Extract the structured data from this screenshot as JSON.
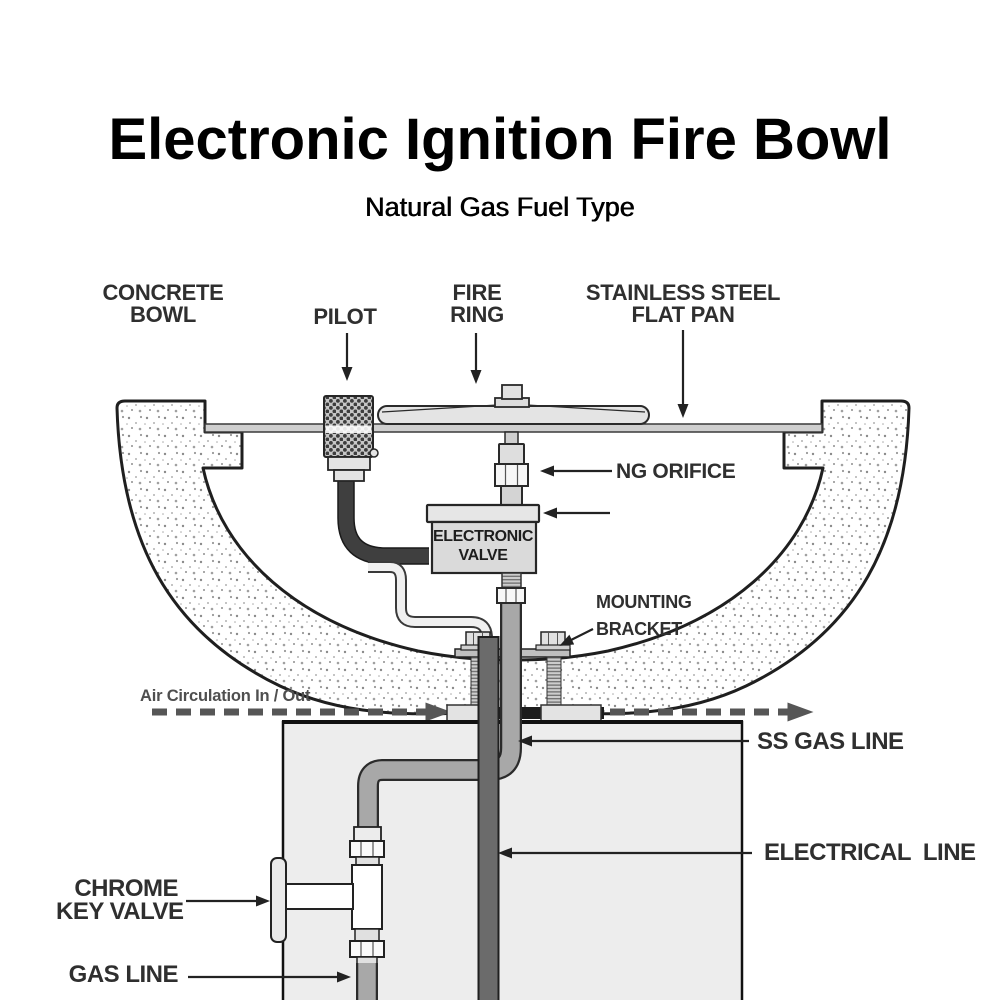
{
  "header": {
    "title": "Electronic Ignition Fire Bowl",
    "subtitle": "Natural Gas Fuel Type"
  },
  "labels": {
    "concrete_bowl": {
      "line1": "CONCRETE",
      "line2": "BOWL"
    },
    "pilot": {
      "line1": "PILOT"
    },
    "fire_ring": {
      "line1": "FIRE",
      "line2": "RING"
    },
    "flat_pan": {
      "line1": "STAINLESS STEEL",
      "line2": "FLAT PAN"
    },
    "ng_orifice": {
      "line1": "NG ORIFICE"
    },
    "electronic_valve": {
      "line1": "ELECTRONIC",
      "line2": "VALVE"
    },
    "mounting_bracket": {
      "line1": "MOUNTING",
      "line2": "BRACKET"
    },
    "air_circulation": {
      "line1": "Air Circulation In / Out"
    },
    "ss_gas_line": {
      "line1": "SS GAS LINE"
    },
    "electrical_line": {
      "line1": "ELECTRICAL  LINE"
    },
    "chrome_key_valve": {
      "line1": "CHROME",
      "line2": "KEY VALVE"
    },
    "gas_line": {
      "line1": "GAS LINE"
    }
  },
  "colors": {
    "label_text": "#2f2f2f",
    "air_circulation_text": "#4f4f4f",
    "arrow": "#222222",
    "air_arrow": "#565656",
    "ss_pipe_gray": "#a8a8a8",
    "electrical_gray": "#6b6b6b",
    "pilot_tube_dark": "#3f3f3f",
    "pedestal_fill": "#ededed",
    "valve_fill": "#dadada",
    "pan_fill": "#cfcfcf"
  }
}
